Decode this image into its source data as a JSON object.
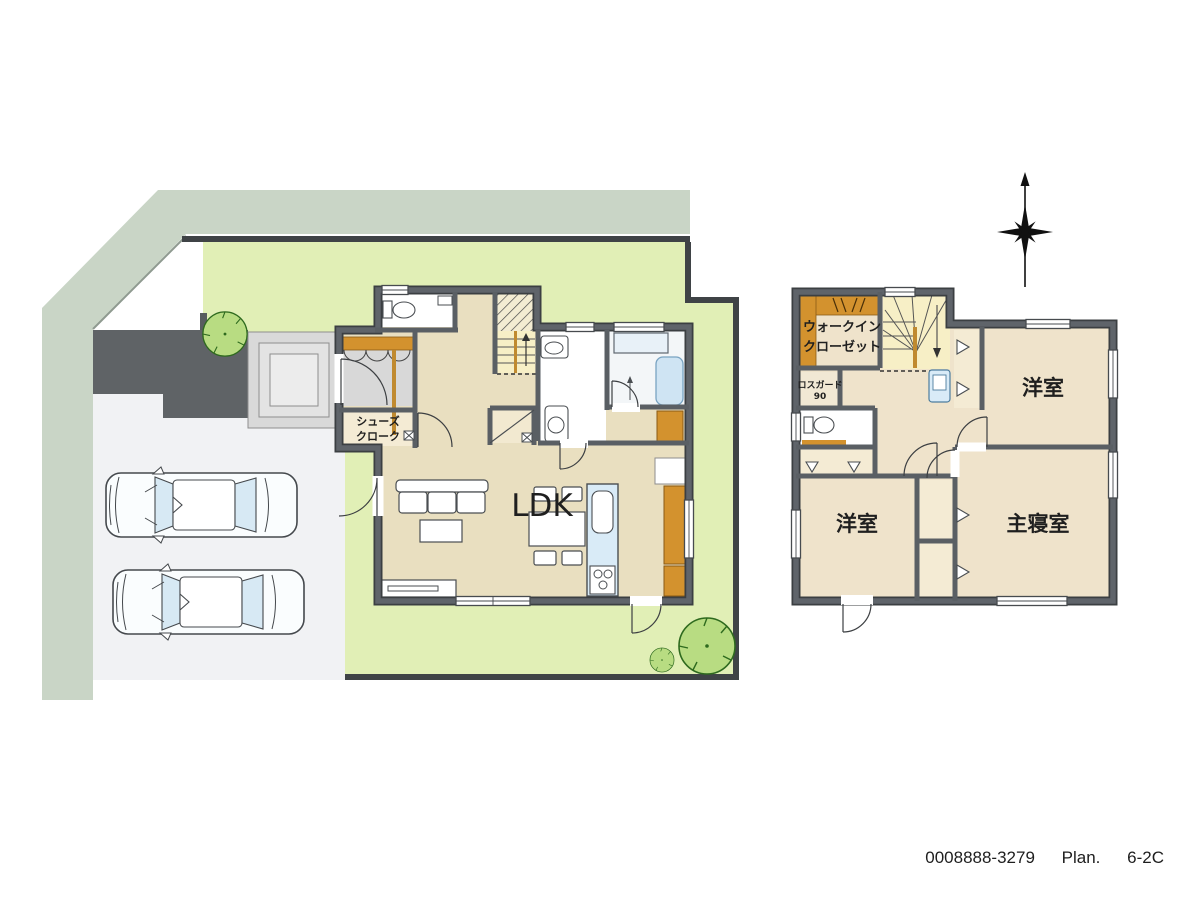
{
  "footer": {
    "plan_code": "0008888-3279",
    "plan_word": "Plan.",
    "plan_number": "6-2C"
  },
  "floor1": {
    "ldk": "LDK",
    "shoes_closet": {
      "line1": "シューズ",
      "line2": "クローク"
    }
  },
  "floor2": {
    "wic": {
      "line1": "ウォークイン",
      "line2": "クローゼット"
    },
    "rosgard": {
      "line1": "ロスガード",
      "line2": "90"
    },
    "western_room_top": "洋室",
    "western_room_bottom": "洋室",
    "master_bedroom": "主寝室"
  },
  "colors": {
    "site_border": "#c9d5c6",
    "lawn": "#e1efb6",
    "approach": "#5f6366",
    "driveway": "#f1f2f4",
    "boundary": "#3f4346",
    "wall": "#5f646a",
    "floor_1f": "#e9dfc0",
    "floor_2f": "#efe3cb",
    "closet": "#f4ebd4",
    "stairs": "#f7efc6",
    "wood": "#d3922e",
    "water_blue": "#d9ebf7",
    "tub_blue": "#cfe4f3",
    "tree": "#b8dc82",
    "porch": "#dedede"
  }
}
